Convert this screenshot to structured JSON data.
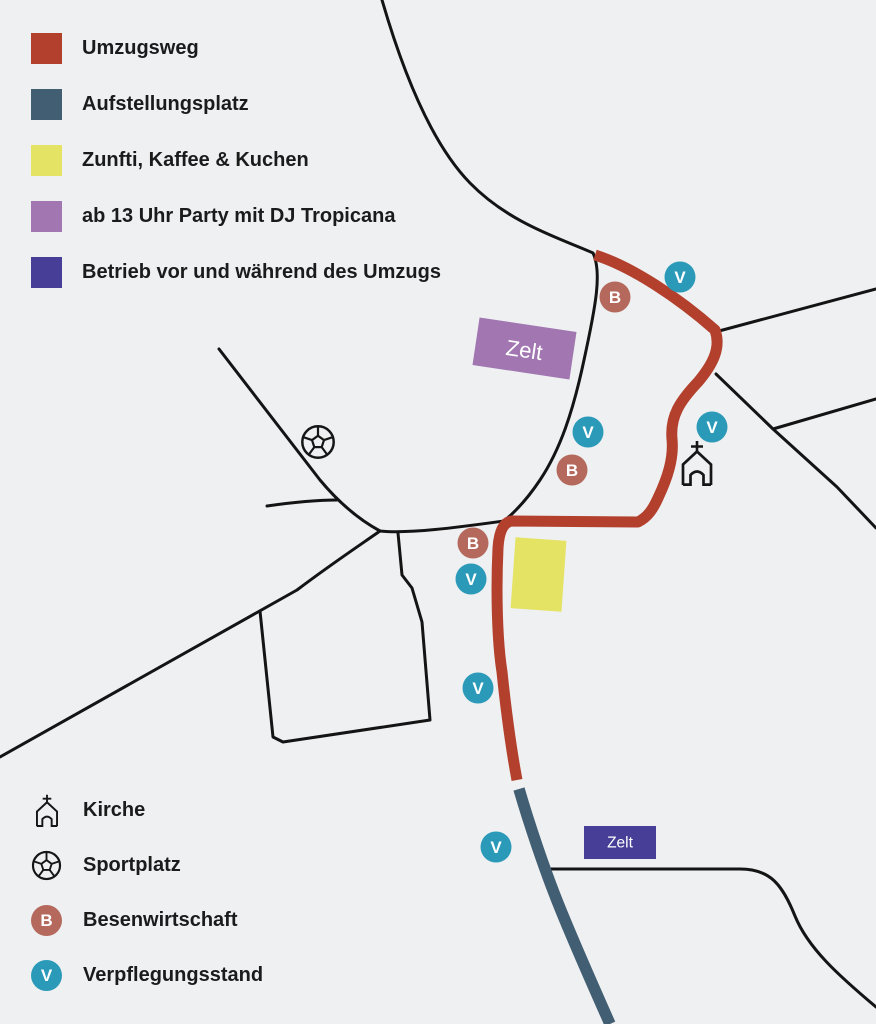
{
  "colors": {
    "background": "#eef0f2",
    "road": "#141414",
    "text": "#1b1b1b",
    "umzugsweg": "#b3402d",
    "aufstellungsplatz": "#425e72",
    "zunfti": "#e5e364",
    "party": "#a176b1",
    "betrieb": "#473f97",
    "besen": "#b5695d",
    "verpflegung": "#2a9ab8"
  },
  "legend_areas": {
    "items": [
      {
        "label": "Umzugsweg",
        "color": "umzugsweg"
      },
      {
        "label": "Aufstellungsplatz",
        "color": "aufstellungsplatz"
      },
      {
        "label": "Zunfti, Kaffee & Kuchen",
        "color": "zunfti"
      },
      {
        "label": "ab 13 Uhr Party mit DJ Tropicana",
        "color": "party"
      },
      {
        "label": "Betrieb vor und während des Umzugs",
        "color": "betrieb"
      }
    ]
  },
  "legend_points": {
    "items": [
      {
        "label": "Kirche",
        "icon": "church-icon"
      },
      {
        "label": "Sportplatz",
        "icon": "soccer-icon"
      },
      {
        "label": "Besenwirtschaft",
        "letter": "B"
      },
      {
        "label": "Verpflegungsstand",
        "letter": "V"
      }
    ]
  },
  "map": {
    "letters": {
      "B": "B",
      "V": "V"
    },
    "tents": {
      "party": {
        "label": "Zelt"
      },
      "betrieb": {
        "label": "Zelt"
      }
    },
    "markers": [
      {
        "type": "V",
        "x": 680,
        "y": 277
      },
      {
        "type": "B",
        "x": 615,
        "y": 297
      },
      {
        "type": "V",
        "x": 588,
        "y": 432
      },
      {
        "type": "B",
        "x": 572,
        "y": 470
      },
      {
        "type": "V",
        "x": 712,
        "y": 427
      },
      {
        "type": "B",
        "x": 473,
        "y": 543
      },
      {
        "type": "V",
        "x": 471,
        "y": 579
      },
      {
        "type": "V",
        "x": 478,
        "y": 688
      },
      {
        "type": "V",
        "x": 496,
        "y": 847
      }
    ]
  }
}
